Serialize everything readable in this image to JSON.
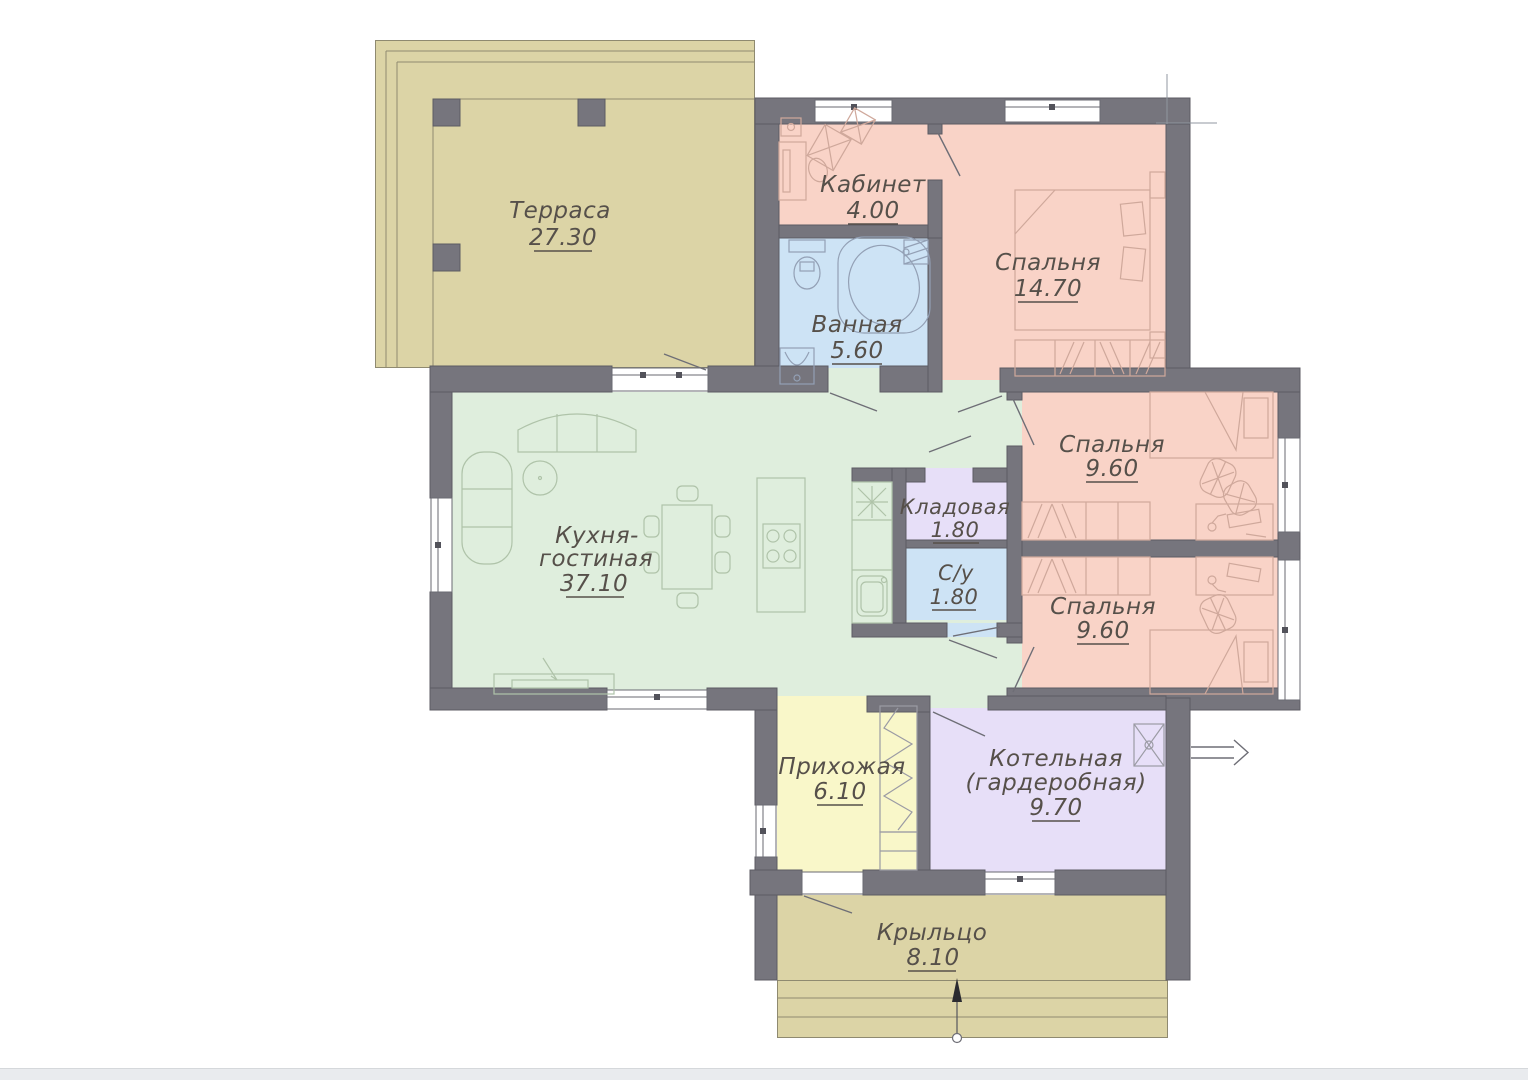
{
  "document": {
    "type": "single-storey house floor plan"
  },
  "colors": {
    "wall": "#76757d",
    "wall-edge": "#5c5b63",
    "room-salmon": "#f9d3c7",
    "room-blue": "#cde3f5",
    "room-green": "#dfeedd",
    "room-lavender": "#e7dff8",
    "room-yellow": "#f9f7c9",
    "room-tan": "#dcd4a6",
    "text": "#56504a",
    "band": "#e9ebee"
  },
  "rooms": {
    "terrace": {
      "name": "Терраса",
      "area": "27.30"
    },
    "office": {
      "name": "Кабинет",
      "area": "4.00"
    },
    "bathroom": {
      "name": "Ванная",
      "area": "5.60"
    },
    "bedroom_main": {
      "name": "Спальня",
      "area": "14.70"
    },
    "kitchen_living": {
      "name_line_1": "Кухня-",
      "name_line_2": "гостиная",
      "area": "37.10"
    },
    "pantry": {
      "name": "Кладовая",
      "area": "1.80"
    },
    "wc": {
      "name": "С/у",
      "area": "1.80"
    },
    "bedroom_top": {
      "name": "Спальня",
      "area": "9.60"
    },
    "bedroom_bottom": {
      "name": "Спальня",
      "area": "9.60"
    },
    "hallway": {
      "name": "Прихожая",
      "area": "6.10"
    },
    "boiler_room": {
      "name_line_1": "Котельная",
      "name_line_2": "(гардеробная)",
      "area": "9.70"
    },
    "porch": {
      "name": "Крыльцо",
      "area": "8.10"
    }
  }
}
